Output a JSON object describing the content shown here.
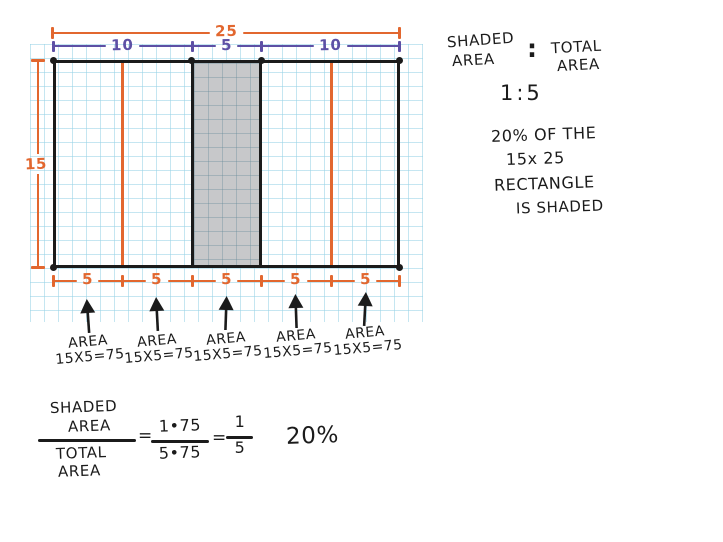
{
  "diagram": {
    "total_width_label": "25",
    "top_segment_labels": [
      "10",
      "5",
      "10"
    ],
    "height_label": "15",
    "bottom_segment_labels": [
      "5",
      "5",
      "5",
      "5",
      "5"
    ],
    "strips": [
      {
        "title": "AREA",
        "formula": "15X5=75"
      },
      {
        "title": "AREA",
        "formula": "15X5=75"
      },
      {
        "title": "AREA",
        "formula": "15X5=75"
      },
      {
        "title": "AREA",
        "formula": "15X5=75"
      },
      {
        "title": "AREA",
        "formula": "15X5=75"
      }
    ]
  },
  "notes": {
    "shaded_word": "SHADED",
    "area_word1": "AREA",
    "colon": ":",
    "total_word": "TOTAL",
    "area_word2": "AREA",
    "ratio": "1:5",
    "line1": "20% OF THE",
    "line2": "15x 25",
    "line3": "RECTANGLE",
    "line4": "IS SHADED"
  },
  "equation": {
    "num_line1": "SHADED",
    "num_line2": "AREA",
    "den_line1": "TOTAL",
    "den_line2": "AREA",
    "eq1": "=",
    "frac2_num": "1•75",
    "frac2_den": "5•75",
    "eq2": "=",
    "frac3_num": "1",
    "frac3_den": "5",
    "result": "20%"
  },
  "colors": {
    "orange": "#E2672F",
    "purple": "#5D50A5",
    "ink": "#1B1B1B",
    "grid_blue": "#BFE3EF",
    "shade_gray": "#C7C8CA"
  }
}
